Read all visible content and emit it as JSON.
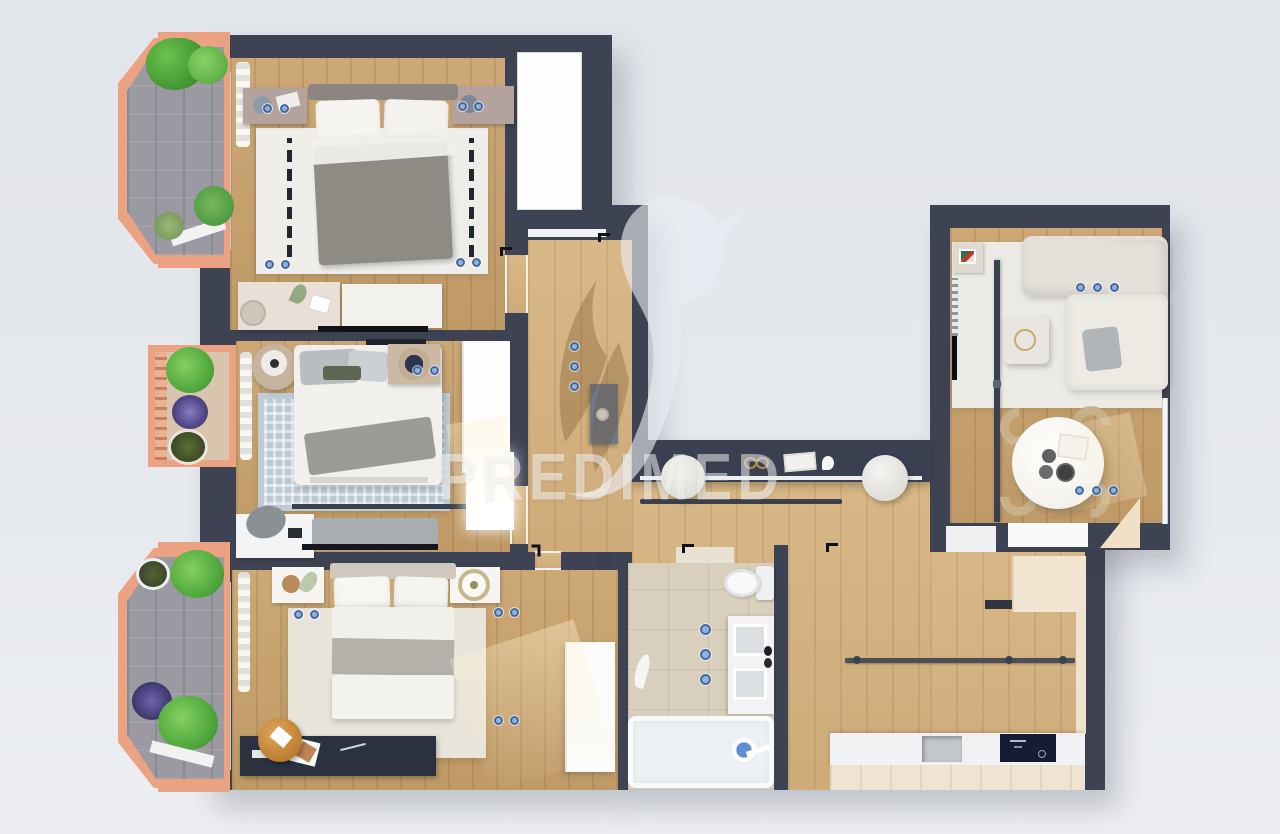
{
  "watermark": {
    "text": "PREDIMED",
    "logo": "hummingbird"
  },
  "palette": {
    "background": "#e4e7ec",
    "wall": "#3e4353",
    "wood_bedroom": "#c9a26c",
    "wood_living": "#d6b27e",
    "bathroom_tile": "#d9cfbd",
    "balcony_tile": "#9b99a1",
    "balcony_frame": "#eba282",
    "rug_dashed_white": "#efede9",
    "rug_blue": "#bcc8d4",
    "rug_cream": "#e9e4da",
    "socket_dot_blue": "#8fb3e0",
    "kitchen_counter": "#f1f1f3",
    "cooktop_dark": "#141d33",
    "closet_cream": "#f1e5d2"
  },
  "rooms": [
    {
      "id": "bedroom-top-left",
      "floor": "wood",
      "furniture": [
        "double-bed",
        "two-nightstands",
        "dashed-pattern-rug",
        "desk-with-stool",
        "white-dresser",
        "tv-bar",
        "curtain"
      ]
    },
    {
      "id": "closet-room",
      "floor": "white",
      "furniture": []
    },
    {
      "id": "bedroom-middle-left",
      "floor": "wood",
      "furniture": [
        "double-bed",
        "round-side-table",
        "nightstand-with-bowl",
        "blue-patterned-rug",
        "wardrobe",
        "lit-dresser",
        "desk-with-chair",
        "bench-blanket",
        "curtain-rod",
        "curtain"
      ]
    },
    {
      "id": "bedroom-bottom-left",
      "floor": "wood",
      "furniture": [
        "double-bed",
        "two-nightstands",
        "cream-rug",
        "wardrobe",
        "dark-desk",
        "round-wood-chair",
        "tall-white-cabinet",
        "curtain"
      ]
    },
    {
      "id": "hallway",
      "floor": "wood",
      "furniture": [
        "console-cabinet",
        "entry-threshold"
      ]
    },
    {
      "id": "bathroom",
      "floor": "tile",
      "furniture": [
        "toilet",
        "double-sink-vanity",
        "bathtub",
        "shower-controls"
      ]
    },
    {
      "id": "living-kitchen-wing",
      "floor": "wood",
      "furniture": [
        "dark-sideboard-console",
        "two-round-stools",
        "wall-rail",
        "kitchen-counter",
        "sink",
        "induction-cooktop",
        "cream-closet-niche",
        "chamfer-door"
      ]
    },
    {
      "id": "living-room",
      "floor": "rug-over-wood",
      "furniture": [
        "corner-sofa",
        "gray-cushion",
        "marble-coffee-table",
        "tv-panel",
        "black-shelf",
        "art-cabinet",
        "radiator-strip"
      ]
    },
    {
      "id": "dining-area",
      "floor": "wood",
      "furniture": [
        "round-table",
        "four-wood-chairs",
        "plates",
        "bowl",
        "book"
      ]
    }
  ],
  "balconies": [
    {
      "id": "balcony-top-left",
      "floor": "gray-tile",
      "frame": "salmon",
      "plants": 4
    },
    {
      "id": "planter-middle-left",
      "floor": "beige",
      "frame": "salmon",
      "plants": 3
    },
    {
      "id": "balcony-bottom-left",
      "floor": "gray-tile",
      "frame": "salmon",
      "plants": 5
    }
  ],
  "sockets": [
    [
      263,
      104
    ],
    [
      280,
      104
    ],
    [
      458,
      102
    ],
    [
      474,
      102
    ],
    [
      265,
      260
    ],
    [
      281,
      260
    ],
    [
      456,
      258
    ],
    [
      472,
      258
    ],
    [
      413,
      366
    ],
    [
      430,
      366
    ],
    [
      294,
      610
    ],
    [
      310,
      610
    ],
    [
      494,
      608
    ],
    [
      510,
      608
    ],
    [
      494,
      716
    ],
    [
      510,
      716
    ],
    [
      570,
      342
    ],
    [
      570,
      362
    ],
    [
      570,
      382
    ],
    [
      1076,
      283
    ],
    [
      1093,
      283
    ],
    [
      1110,
      283
    ],
    [
      1075,
      486
    ],
    [
      1092,
      486
    ],
    [
      1109,
      486
    ]
  ]
}
